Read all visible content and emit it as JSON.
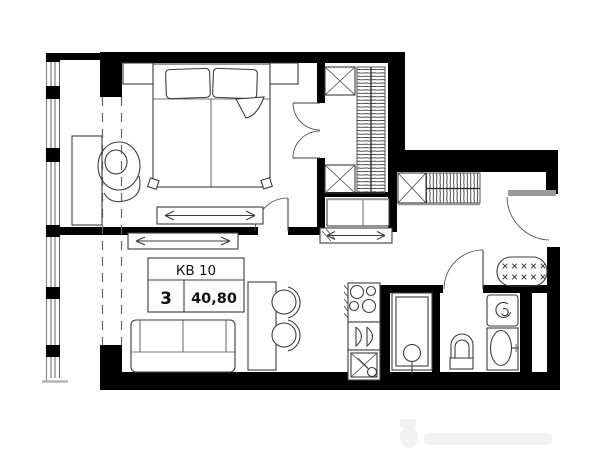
{
  "plan": {
    "title": "Apartment floor plan",
    "unit": {
      "label": "КВ 10",
      "rooms": "3",
      "area": "40,80"
    },
    "colors": {
      "wall": "#000000",
      "furniture_line": "#3d3d3d",
      "door_leaf_gray": "#9a9a9a",
      "dashed_line": "#666666",
      "accent_gray": "#999999"
    }
  }
}
